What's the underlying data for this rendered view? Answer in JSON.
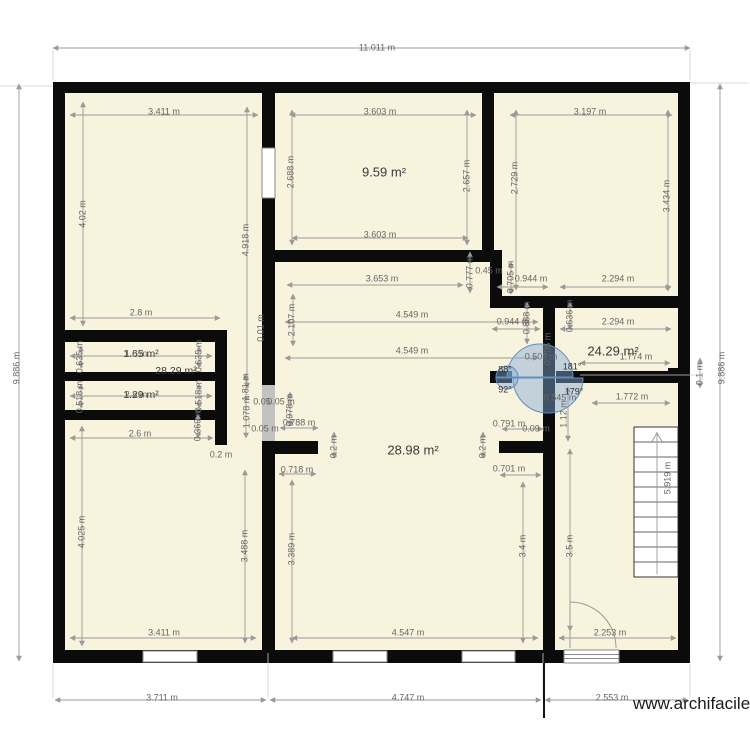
{
  "watermark": "www.archifacile.fr",
  "colors": {
    "floor": "#f8f3dc",
    "wall": "#0b0b0b",
    "dimension_line": "#9a9a9a",
    "dimension_text": "#666666",
    "area_text": "#3a3a3a",
    "door_fill": "#a9c6e4",
    "door_stroke": "#5d8fc0",
    "window": "#ffffff",
    "open_door_gap": "#c2c2c2"
  },
  "labels": [
    {
      "t": "11.011 m",
      "x": 377,
      "y": 48
    },
    {
      "t": "9.886 m",
      "x": 17,
      "y": 368,
      "r": 1
    },
    {
      "t": "9.886 m",
      "x": 722,
      "y": 368,
      "r": 1
    },
    {
      "t": "3.711 m",
      "x": 162,
      "y": 698
    },
    {
      "t": "4.747 m",
      "x": 408,
      "y": 698
    },
    {
      "t": "2.553 m",
      "x": 612,
      "y": 698
    },
    {
      "t": "3.411 m",
      "x": 164,
      "y": 112
    },
    {
      "t": "4.02 m",
      "x": 83,
      "y": 214,
      "r": 1
    },
    {
      "t": "3.603 m",
      "x": 380,
      "y": 112
    },
    {
      "t": "2.688 m",
      "x": 291,
      "y": 172,
      "r": 1
    },
    {
      "t": "2.657 m",
      "x": 467,
      "y": 176,
      "r": 1
    },
    {
      "t": "3.603 m",
      "x": 380,
      "y": 235
    },
    {
      "t": "3.197 m",
      "x": 590,
      "y": 112
    },
    {
      "t": "2.729 m",
      "x": 515,
      "y": 178,
      "r": 1
    },
    {
      "t": "3.434 m",
      "x": 667,
      "y": 196,
      "r": 1
    },
    {
      "t": "4.918 m",
      "x": 246,
      "y": 240,
      "r": 1
    },
    {
      "t": "3.653 m",
      "x": 382,
      "y": 279
    },
    {
      "t": "0.777 m",
      "x": 470,
      "y": 272,
      "r": 1
    },
    {
      "t": "0.45 m",
      "x": 489,
      "y": 271
    },
    {
      "t": "0.705 m",
      "x": 511,
      "y": 277,
      "r": 1
    },
    {
      "t": "0.944 m",
      "x": 531,
      "y": 279
    },
    {
      "t": "2.294 m",
      "x": 618,
      "y": 279
    },
    {
      "t": "2.107 m",
      "x": 292,
      "y": 320,
      "r": 1
    },
    {
      "t": "0.01 m",
      "x": 261,
      "y": 328,
      "r": 1
    },
    {
      "t": "4.549 m",
      "x": 412,
      "y": 315
    },
    {
      "t": "0.944 m",
      "x": 513,
      "y": 322
    },
    {
      "t": "0.888 m",
      "x": 527,
      "y": 318,
      "r": 1
    },
    {
      "t": "2.294 m",
      "x": 618,
      "y": 322
    },
    {
      "t": "0.636 m",
      "x": 570,
      "y": 316,
      "r": 1
    },
    {
      "t": "4.549 m",
      "x": 412,
      "y": 351
    },
    {
      "t": "1.774 m",
      "x": 636,
      "y": 357
    },
    {
      "t": "0.505 m",
      "x": 541,
      "y": 357
    },
    {
      "t": "0.705 m",
      "x": 548,
      "y": 349,
      "r": 1
    },
    {
      "t": "88°",
      "x": 505,
      "y": 370,
      "c": "g"
    },
    {
      "t": "181°",
      "x": 572,
      "y": 367,
      "c": "g"
    },
    {
      "t": "92°",
      "x": 505,
      "y": 390,
      "c": "g"
    },
    {
      "t": "179°",
      "x": 574,
      "y": 392,
      "c": "g"
    },
    {
      "t": "0.545 m",
      "x": 560,
      "y": 398
    },
    {
      "t": "1.772 m",
      "x": 632,
      "y": 397
    },
    {
      "t": "1.12 m",
      "x": 564,
      "y": 414,
      "r": 1
    },
    {
      "t": "0.1 m",
      "x": 700,
      "y": 374,
      "r": 1
    },
    {
      "t": "2.8 m",
      "x": 141,
      "y": 313
    },
    {
      "t": "0.635 m",
      "x": 80,
      "y": 357,
      "r": 1
    },
    {
      "t": "0.635 m",
      "x": 199,
      "y": 356,
      "r": 1
    },
    {
      "t": "1.65 m²",
      "x": 141,
      "y": 354,
      "c": "s"
    },
    {
      "t": "1.8 m",
      "x": 136,
      "y": 354
    },
    {
      "t": "28.29 m²",
      "x": 176,
      "y": 371,
      "c": "s"
    },
    {
      "t": "0.518 m",
      "x": 80,
      "y": 397,
      "r": 1
    },
    {
      "t": "0.518 m",
      "x": 199,
      "y": 396,
      "r": 1
    },
    {
      "t": "1.29 m²",
      "x": 141,
      "y": 395,
      "c": "s"
    },
    {
      "t": "2.8 m",
      "x": 136,
      "y": 395
    },
    {
      "t": "0.369 m",
      "x": 198,
      "y": 425,
      "r": 1
    },
    {
      "t": "1.81 m",
      "x": 246,
      "y": 387,
      "r": 1
    },
    {
      "t": "1.078 m",
      "x": 247,
      "y": 412,
      "r": 1
    },
    {
      "t": "0.05",
      "x": 262,
      "y": 402
    },
    {
      "t": "0.05 m",
      "x": 281,
      "y": 402
    },
    {
      "t": "0.05 m",
      "x": 265,
      "y": 429
    },
    {
      "t": "0.978 m",
      "x": 290,
      "y": 410,
      "r": 1
    },
    {
      "t": "0.788 m",
      "x": 299,
      "y": 423
    },
    {
      "t": "0.2 m",
      "x": 221,
      "y": 455
    },
    {
      "t": "2.6 m",
      "x": 140,
      "y": 434
    },
    {
      "t": "4.025 m",
      "x": 82,
      "y": 532,
      "r": 1
    },
    {
      "t": "3.488 m",
      "x": 245,
      "y": 546,
      "r": 1
    },
    {
      "t": "3.389 m",
      "x": 292,
      "y": 549,
      "r": 1
    },
    {
      "t": "0.718 m",
      "x": 297,
      "y": 470
    },
    {
      "t": "3.411 m",
      "x": 164,
      "y": 633
    },
    {
      "t": "0.2 m",
      "x": 334,
      "y": 447,
      "r": 1
    },
    {
      "t": "0.2 m",
      "x": 483,
      "y": 447,
      "r": 1
    },
    {
      "t": "0.791 m",
      "x": 509,
      "y": 424
    },
    {
      "t": "0.09 m",
      "x": 536,
      "y": 429
    },
    {
      "t": "0.701 m",
      "x": 509,
      "y": 469
    },
    {
      "t": "3.4 m",
      "x": 523,
      "y": 546,
      "r": 1
    },
    {
      "t": "3.5 m",
      "x": 570,
      "y": 546,
      "r": 1
    },
    {
      "t": "5.919 m",
      "x": 668,
      "y": 478,
      "r": 1
    },
    {
      "t": "4.547 m",
      "x": 408,
      "y": 633
    },
    {
      "t": "2.253 m",
      "x": 610,
      "y": 633
    },
    {
      "t": "9.59 m²",
      "x": 384,
      "y": 172,
      "c": "a"
    },
    {
      "t": "24.29 m²",
      "x": 613,
      "y": 351,
      "c": "a"
    },
    {
      "t": "28.98 m²",
      "x": 413,
      "y": 450,
      "c": "a"
    }
  ]
}
